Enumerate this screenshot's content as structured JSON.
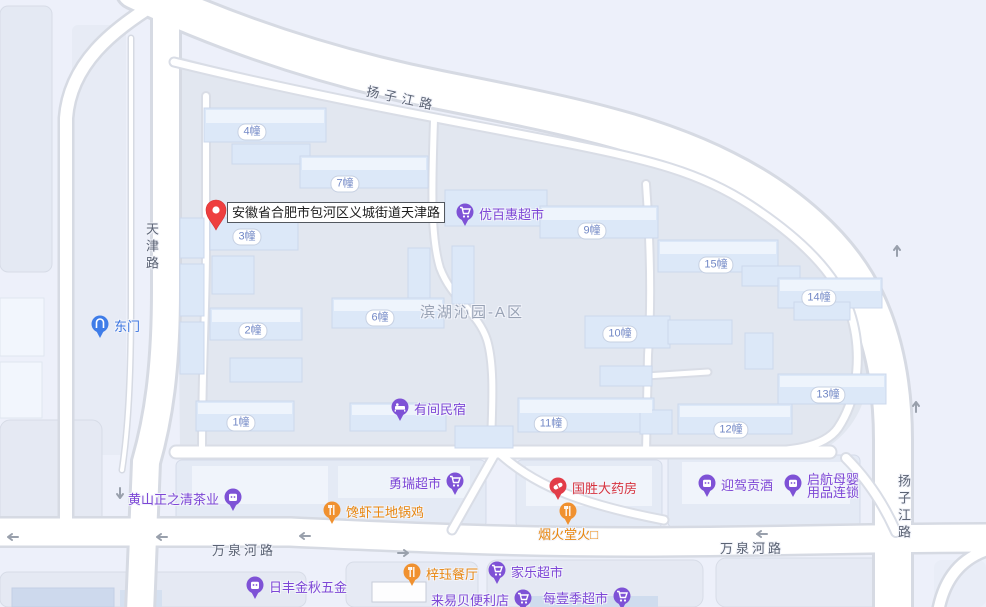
{
  "map": {
    "address_marker": "安徽省合肥市包河区义城街道天津路",
    "area_label": "滨湖沁园-A区",
    "road_labels": {
      "yangzijiang_top": "扬子江路",
      "yangzijiang_right": "扬子江路",
      "tianjin": "天津路",
      "wanquanhe_west": "万泉河路",
      "wanquanhe_east": "万泉河路"
    },
    "building_badges": [
      "4幢",
      "7幢",
      "3幢",
      "9幢",
      "15幢",
      "14幢",
      "2幢",
      "6幢",
      "10幢",
      "13幢",
      "1幢",
      "11幢",
      "12幢"
    ],
    "pois": [
      {
        "name": "东门",
        "type": "gate",
        "color": "blue"
      },
      {
        "name": "优百惠超市",
        "type": "supermarket",
        "color": "purple"
      },
      {
        "name": "有间民宿",
        "type": "hostel",
        "color": "purple"
      },
      {
        "name": "勇瑞超市",
        "type": "supermarket",
        "color": "purple"
      },
      {
        "name": "黄山正之清茶业",
        "type": "shop",
        "color": "purple"
      },
      {
        "name": "馋虾王地锅鸡",
        "type": "restaurant",
        "color": "orange"
      },
      {
        "name": "国胜大药房",
        "type": "pharmacy",
        "color": "red"
      },
      {
        "name": "烟火堂火□",
        "type": "restaurant",
        "color": "orange"
      },
      {
        "name": "迎驾贡酒",
        "type": "shop",
        "color": "purple"
      },
      {
        "name": "启航母婴用品连锁",
        "lines": [
          "启航母婴",
          "用品连锁"
        ],
        "type": "shop",
        "color": "purple"
      },
      {
        "name": "日丰金秋五金",
        "type": "shop",
        "color": "purple"
      },
      {
        "name": "梓珏餐厅",
        "type": "restaurant",
        "color": "orange"
      },
      {
        "name": "家乐超市",
        "type": "supermarket",
        "color": "purple"
      },
      {
        "name": "来易贝便利店",
        "type": "supermarket",
        "color": "purple"
      },
      {
        "name": "每壹季超市",
        "type": "supermarket",
        "color": "purple"
      }
    ],
    "colors": {
      "poi_purple": "#7d46d6",
      "poi_orange": "#e8860f",
      "poi_red": "#d6333f",
      "poi_blue": "#3f77e0",
      "pin_red": "#ee3f3f",
      "road_fill": "#ffffff",
      "block_fill": "#e2e7f0"
    }
  }
}
